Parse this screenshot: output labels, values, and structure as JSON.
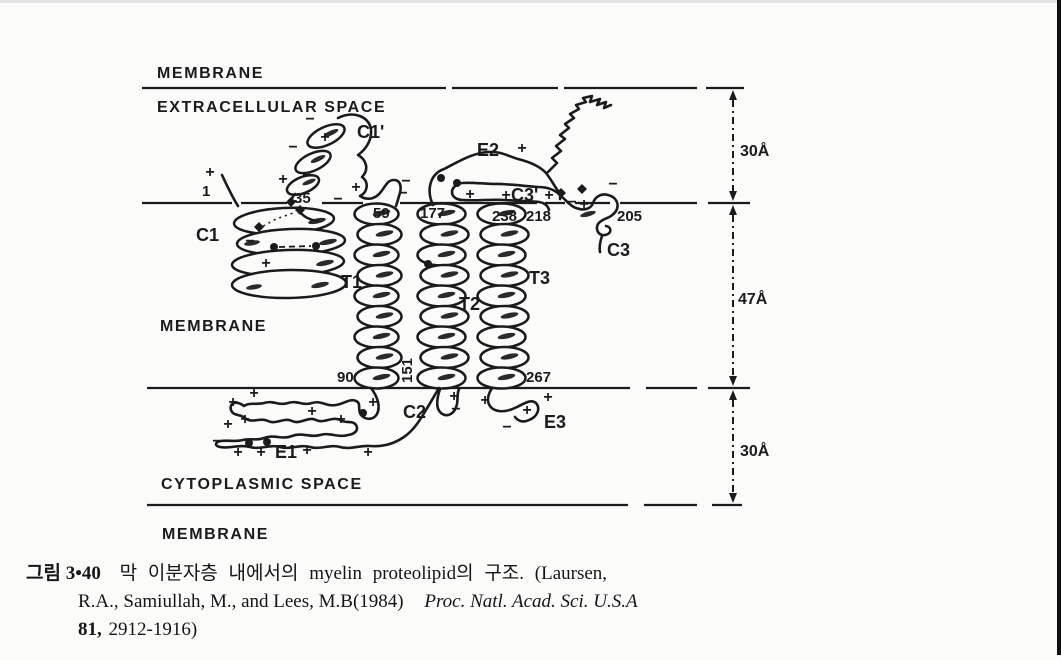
{
  "page": {
    "background": "#fbfbfa",
    "ink_color": "#1b1b1b",
    "edge_bar_color": "#101010"
  },
  "diagram": {
    "region_labels": [
      {
        "id": "membrane-top",
        "text": "MEMBRANE",
        "x": 157,
        "y": 78
      },
      {
        "id": "extracellular-space",
        "text": "EXTRACELLULAR SPACE",
        "x": 157,
        "y": 112
      },
      {
        "id": "membrane-middle",
        "text": "MEMBRANE",
        "x": 160,
        "y": 331
      },
      {
        "id": "cytoplasmic-space",
        "text": "CYTOPLASMIC SPACE",
        "x": 161,
        "y": 489
      },
      {
        "id": "membrane-bottom",
        "text": "MEMBRANE",
        "x": 162,
        "y": 539
      }
    ],
    "segment_labels": [
      {
        "id": "C1",
        "text": "C1",
        "x": 196,
        "y": 241
      },
      {
        "id": "C1-prime",
        "text": "C1'",
        "x": 357,
        "y": 138
      },
      {
        "id": "T1",
        "text": "T1",
        "x": 341,
        "y": 288
      },
      {
        "id": "T2",
        "text": "T2",
        "x": 459,
        "y": 310
      },
      {
        "id": "T3",
        "text": "T3",
        "x": 529,
        "y": 284
      },
      {
        "id": "C2",
        "text": "C2",
        "x": 403,
        "y": 418
      },
      {
        "id": "C3",
        "text": "C3",
        "x": 607,
        "y": 256
      },
      {
        "id": "C3-prime",
        "text": "C3'",
        "x": 511,
        "y": 201
      },
      {
        "id": "E1",
        "text": "E1",
        "x": 275,
        "y": 458
      },
      {
        "id": "E2",
        "text": "E2",
        "x": 477,
        "y": 156
      },
      {
        "id": "E3",
        "text": "E3",
        "x": 544,
        "y": 428
      }
    ],
    "residue_numbers": [
      {
        "text": "1",
        "x": 202,
        "y": 196
      },
      {
        "text": "35",
        "x": 294,
        "y": 203
      },
      {
        "text": "59",
        "x": 373,
        "y": 218
      },
      {
        "text": "90",
        "x": 337,
        "y": 382
      },
      {
        "text": "151",
        "x": 412,
        "y": 383,
        "rotate": -90
      },
      {
        "text": "177",
        "x": 420,
        "y": 218
      },
      {
        "text": "238",
        "x": 492,
        "y": 221
      },
      {
        "text": "218",
        "x": 526,
        "y": 221
      },
      {
        "text": "205",
        "x": 617,
        "y": 221
      },
      {
        "text": "267",
        "x": 526,
        "y": 382
      }
    ],
    "measurements": [
      {
        "text": "30Å",
        "x": 740,
        "y": 156
      },
      {
        "text": "47Å",
        "x": 738,
        "y": 304
      },
      {
        "text": "30Å",
        "x": 740,
        "y": 456
      }
    ],
    "charges": [
      {
        "t": "+",
        "x": 210,
        "y": 172
      },
      {
        "t": "−",
        "x": 310,
        "y": 119
      },
      {
        "t": "+",
        "x": 325,
        "y": 137
      },
      {
        "t": "−",
        "x": 293,
        "y": 147
      },
      {
        "t": "+",
        "x": 283,
        "y": 179
      },
      {
        "t": "−",
        "x": 307,
        "y": 175
      },
      {
        "t": "+",
        "x": 356,
        "y": 187
      },
      {
        "t": "−",
        "x": 338,
        "y": 199
      },
      {
        "t": "−",
        "x": 406,
        "y": 181
      },
      {
        "t": "−",
        "x": 403,
        "y": 193
      },
      {
        "t": "+",
        "x": 522,
        "y": 148
      },
      {
        "t": "−",
        "x": 499,
        "y": 184
      },
      {
        "t": "+",
        "x": 470,
        "y": 194
      },
      {
        "t": "+",
        "x": 506,
        "y": 195
      },
      {
        "t": "+",
        "x": 549,
        "y": 195
      },
      {
        "t": "−",
        "x": 572,
        "y": 202
      },
      {
        "t": "+",
        "x": 584,
        "y": 204
      },
      {
        "t": "−",
        "x": 613,
        "y": 184
      },
      {
        "t": "−",
        "x": 250,
        "y": 241
      },
      {
        "t": "+",
        "x": 266,
        "y": 263
      },
      {
        "t": "+",
        "x": 254,
        "y": 393
      },
      {
        "t": "+",
        "x": 233,
        "y": 402
      },
      {
        "t": "+",
        "x": 245,
        "y": 419
      },
      {
        "t": "+",
        "x": 228,
        "y": 424
      },
      {
        "t": "+",
        "x": 312,
        "y": 411
      },
      {
        "t": "+",
        "x": 341,
        "y": 419
      },
      {
        "t": "+",
        "x": 373,
        "y": 402
      },
      {
        "t": "−",
        "x": 217,
        "y": 441
      },
      {
        "t": "+",
        "x": 238,
        "y": 452
      },
      {
        "t": "+",
        "x": 261,
        "y": 452
      },
      {
        "t": "+",
        "x": 307,
        "y": 450
      },
      {
        "t": "+",
        "x": 368,
        "y": 452
      },
      {
        "t": "+",
        "x": 454,
        "y": 396
      },
      {
        "t": "−",
        "x": 456,
        "y": 409
      },
      {
        "t": "+",
        "x": 485,
        "y": 400
      },
      {
        "t": "+",
        "x": 548,
        "y": 397
      },
      {
        "t": "+",
        "x": 527,
        "y": 410
      },
      {
        "t": "−",
        "x": 507,
        "y": 427
      }
    ],
    "dots": [
      {
        "x": 274,
        "y": 247
      },
      {
        "x": 316,
        "y": 246
      },
      {
        "x": 428,
        "y": 264
      },
      {
        "x": 363,
        "y": 413
      },
      {
        "x": 249,
        "y": 443
      },
      {
        "x": 267,
        "y": 442
      },
      {
        "x": 441,
        "y": 178
      },
      {
        "x": 457,
        "y": 183
      }
    ],
    "diamonds": [
      {
        "x": 259,
        "y": 227
      },
      {
        "x": 291,
        "y": 202
      },
      {
        "x": 300,
        "y": 210
      },
      {
        "x": 561,
        "y": 193
      },
      {
        "x": 582,
        "y": 189
      }
    ]
  },
  "caption": {
    "figure_label": "그림 3•40",
    "title_ko": "막 이분자층 내에서의 myelin proteolipid의 구조.",
    "citation_intro": "(Laursen,",
    "citation_line2": "R.A., Samiullah, M., and Lees, M.B(1984)",
    "journal": "Proc. Natl. Acad. Sci. U.S.A",
    "volume": "81,",
    "pages": "2912-1916)"
  }
}
